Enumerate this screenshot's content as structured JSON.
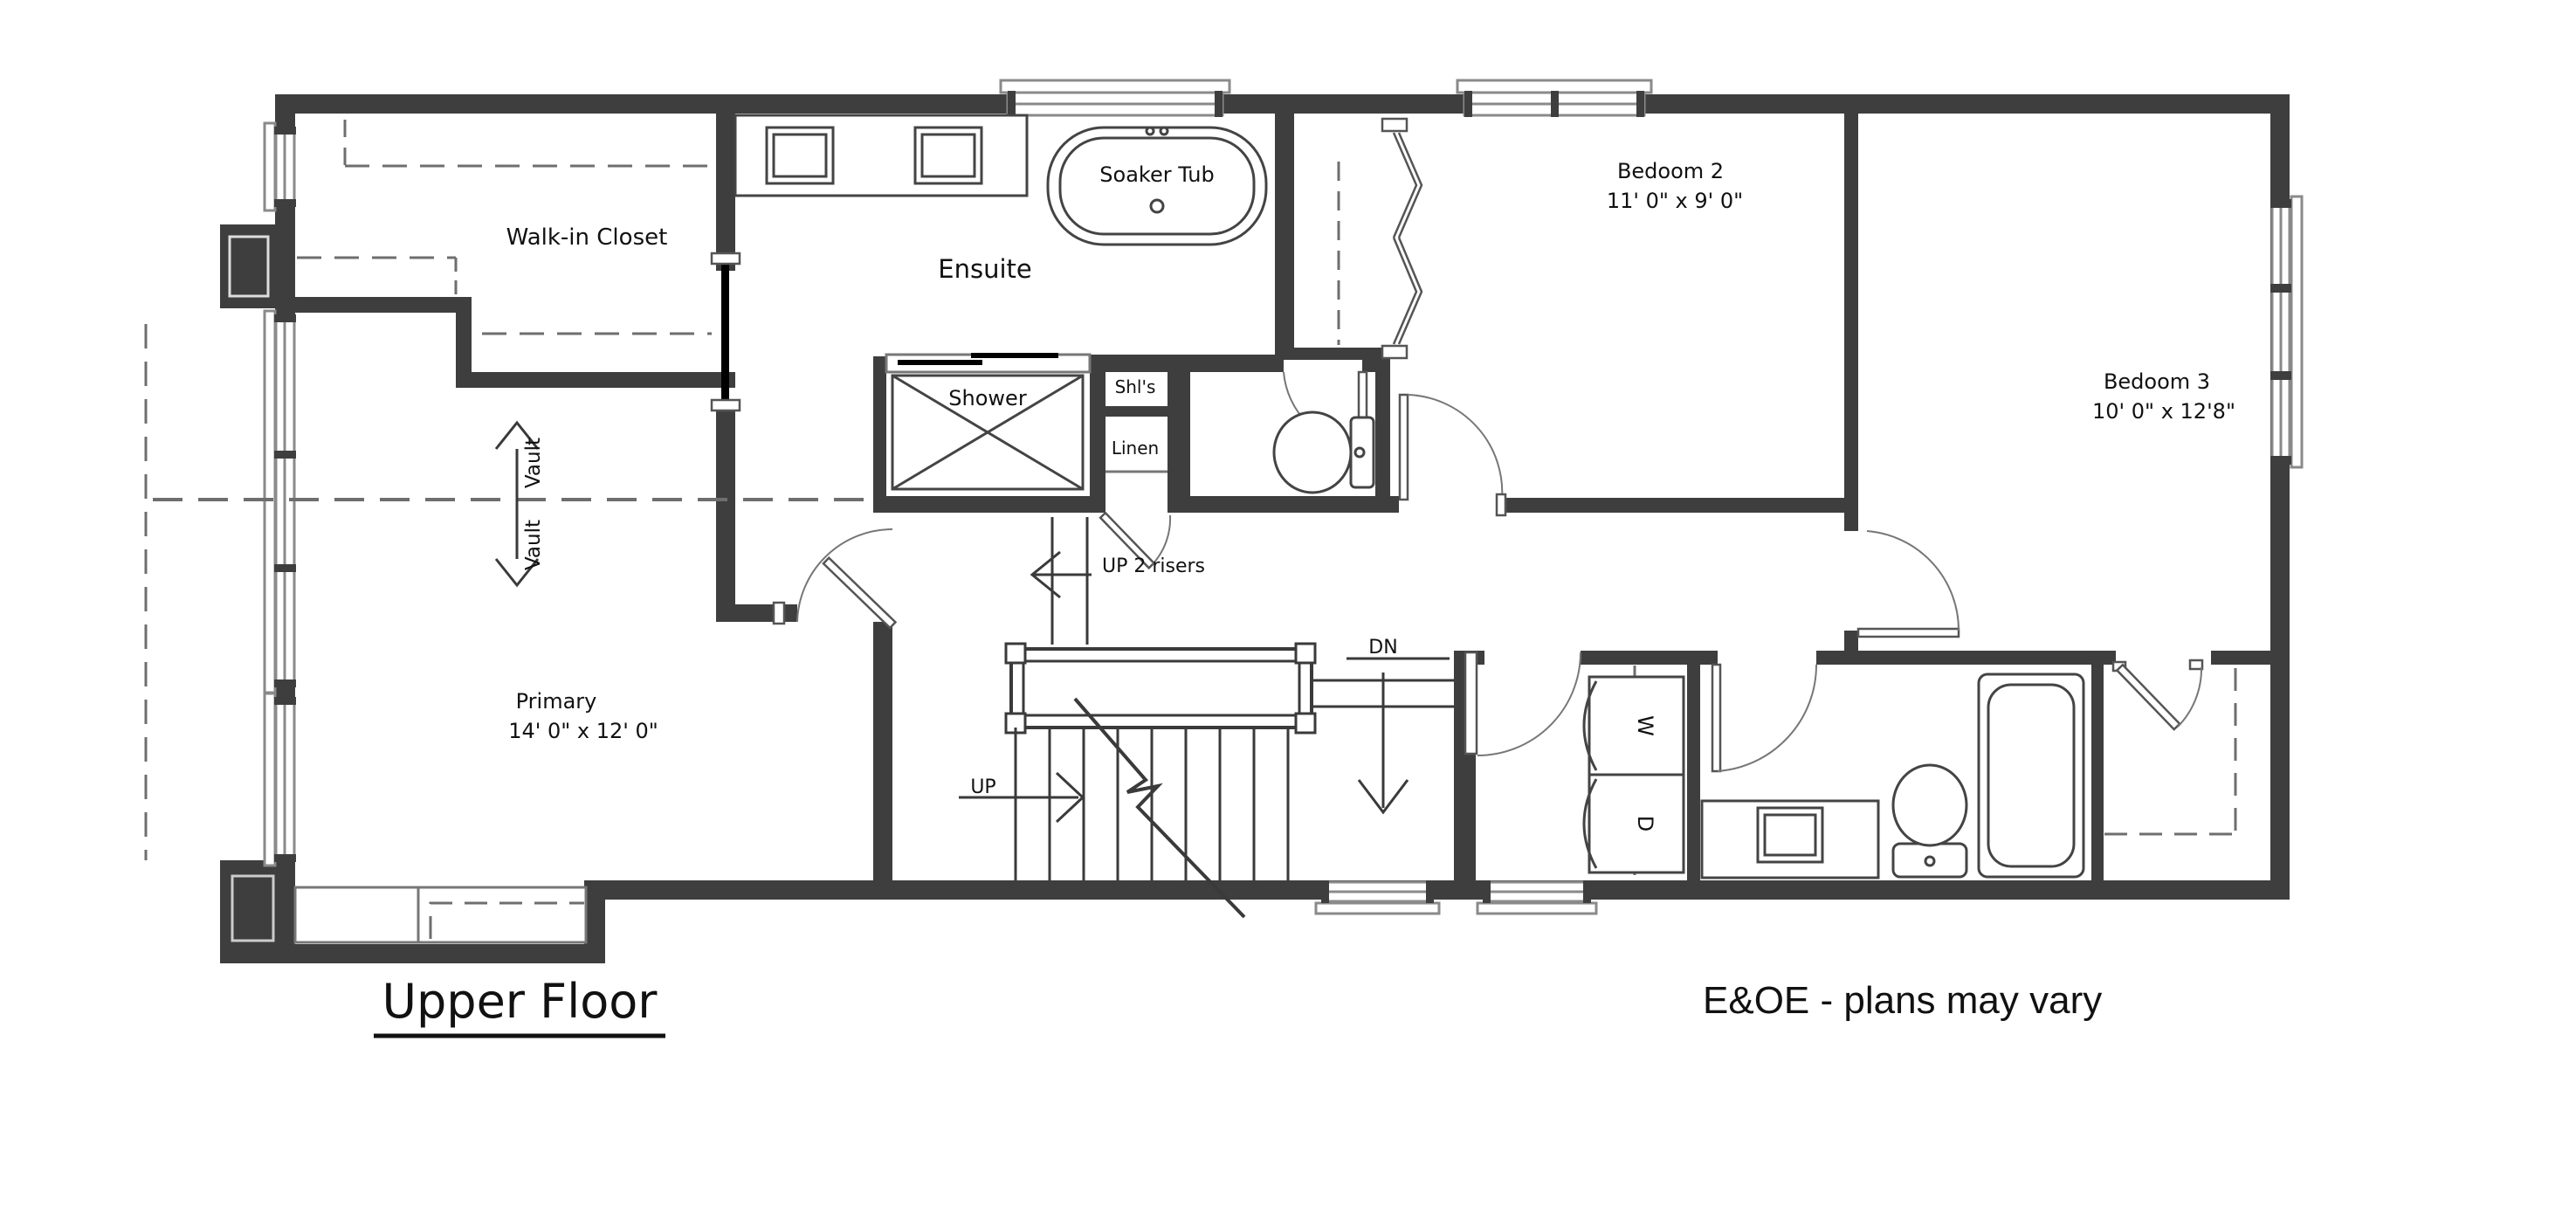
{
  "plan": {
    "title": "Upper Floor",
    "disclaimer": "E&OE - plans may vary",
    "rooms": {
      "walk_in_closet": {
        "label": "Walk-in Closet"
      },
      "ensuite": {
        "label": "Ensuite"
      },
      "soaker_tub": {
        "label": "Soaker Tub"
      },
      "shower": {
        "label": "Shower"
      },
      "shelves": {
        "label": "Shl's"
      },
      "linen": {
        "label": "Linen"
      },
      "bedroom2": {
        "label": "Bedoom 2",
        "dimensions": "11' 0\" x 9' 0\""
      },
      "bedroom3": {
        "label": "Bedoom 3",
        "dimensions": "10' 0\" x 12'8\""
      },
      "primary": {
        "label": "Primary",
        "dimensions": "14' 0\" x 12' 0\""
      },
      "laundry": {
        "washer": "W",
        "dryer": "D"
      }
    },
    "annotations": {
      "vault_upper": "Vault",
      "vault_lower": "Vault",
      "up_2_risers": "UP 2 risers",
      "up": "UP",
      "dn": "DN"
    },
    "colors": {
      "wall": "#3e3e3e",
      "line": "#3a3a3a",
      "text": "#111111",
      "background": "#ffffff"
    }
  }
}
